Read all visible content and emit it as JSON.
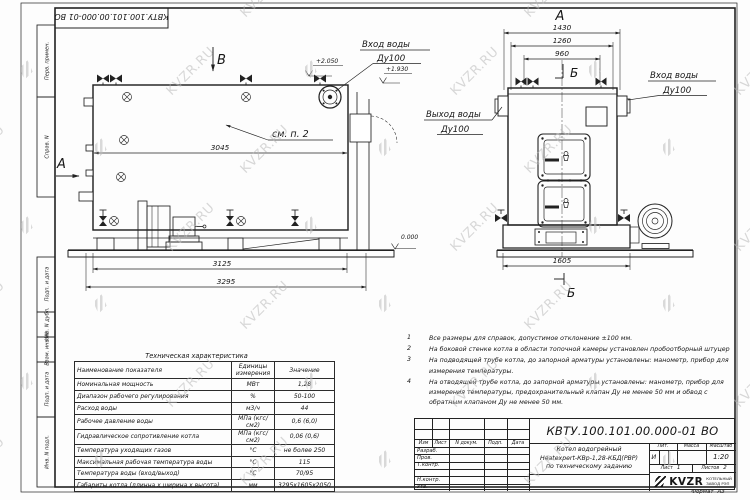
{
  "watermark": {
    "text": "KVZR.RU"
  },
  "sheet": {
    "stamp": "КВТУ.100.101.00.000-01 ВО",
    "sidebar": [
      "Перв. примен.",
      "Справ. N",
      "Подп. и дата",
      "Инв. N дубл.",
      "Взам. инв. N",
      "Подп. и дата",
      "Инв. N подл."
    ],
    "format_label": "Формат",
    "format_value": "А3"
  },
  "side_view": {
    "section_b": "В",
    "section_a": "А",
    "see_note": "см. п. 2",
    "dim_3045": "3045",
    "dim_3125": "3125",
    "dim_3295": "3295",
    "level_top": "+2.050",
    "level_mid": "+1.930",
    "level_zero": "0.000",
    "inlet_line1": "Вход воды",
    "inlet_line2": "Ду100"
  },
  "front_view": {
    "section_a": "А",
    "section_b_top": "Б",
    "section_b_bottom": "Б",
    "dim_1430": "1430",
    "dim_1260": "1260",
    "dim_960": "960",
    "dim_1605": "1605",
    "outlet_line1": "Выход воды",
    "outlet_line2": "Ду100",
    "inlet_line1": "Вход воды",
    "inlet_line2": "Ду100"
  },
  "tech_table": {
    "title": "Техническая характеристика",
    "headers": [
      "Наименование показателя",
      "Единицы измерения",
      "Значение"
    ],
    "rows": [
      [
        "Номинальная мощность",
        "МВт",
        "1,28"
      ],
      [
        "Диапазон рабочего регулирования",
        "%",
        "50-100"
      ],
      [
        "Расход воды",
        "м3/ч",
        "44"
      ],
      [
        "Рабочее давление воды",
        "МПа (кгс/см2)",
        "0,6 (6,0)"
      ],
      [
        "Гидравлическое сопротивление котла",
        "МПа (кгс/см2)",
        "0,06 (0,6)"
      ],
      [
        "Температура уходящих газов",
        "°С",
        "не более 250"
      ],
      [
        "Максимальная рабочая температура воды",
        "°С",
        "115"
      ],
      [
        "Температура воды (вход/выход)",
        "°С",
        "70/95"
      ],
      [
        "Габариты котла (длинна х ширина х высота)",
        "мм",
        "3295х1605х2050"
      ]
    ]
  },
  "notes": [
    {
      "n": "1",
      "text": "Все размеры для справок, допустимое отклонение ±100 мм."
    },
    {
      "n": "2",
      "text": "На боковой стенке котла в области топочной камеры установлен пробоотборный штуцер"
    },
    {
      "n": "3",
      "text": "На подводящей трубе котла, до запорной арматуры установлены: манометр, прибор для измерения температуры."
    },
    {
      "n": "4",
      "text": "На отводящей трубе котла, до запорной арматуры установлены: манометр, прибор для измерения температуры, предохранительный клапан Ду не менее 50 мм и обвод с обратным клапаном Ду не менее 50 мм."
    }
  ],
  "title_block": {
    "designation": "КВТУ.100.101.00.000-01 ВО",
    "change_cols": [
      "Изм",
      "Лист",
      "N докум.",
      "Подп.",
      "Дата"
    ],
    "roles": [
      "Разраб.",
      "Пров.",
      "Т.контр.",
      "",
      "Н.контр.",
      "Утв."
    ],
    "product_line1": "Котел водогрейный",
    "product_line2": "Heatexpert-КВр-1,28-КБД(РВР)",
    "product_line3": "по техническому заданию",
    "lit_header": "Лит.",
    "mass_header": "Масса",
    "scale_header": "Масштаб",
    "lit_value": "И",
    "scale_value": "1:20",
    "sheet_label": "Лист",
    "sheet_value": "1",
    "sheets_label": "Листов",
    "sheets_value": "2",
    "logo_word": "KVZR",
    "company_line1": "КОТЕЛЬНЫЙ",
    "company_line2": "ЗАВОД РЭП"
  }
}
